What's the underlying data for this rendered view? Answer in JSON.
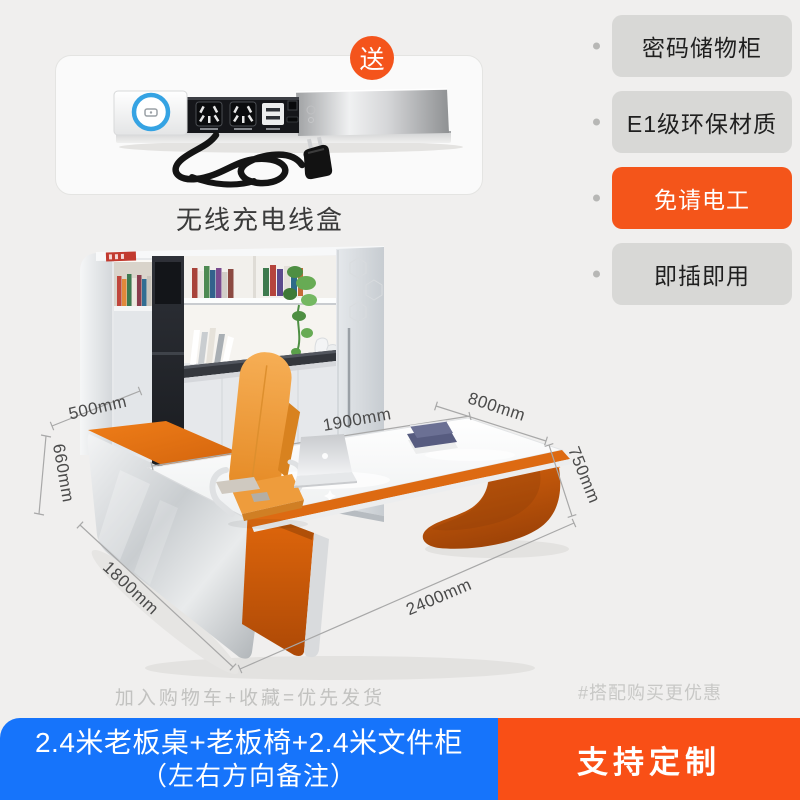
{
  "gift_section": {
    "badge_label": "送",
    "caption": "无线充电线盒"
  },
  "features": {
    "items": [
      {
        "label": "密码储物柜",
        "highlighted": false
      },
      {
        "label": "E1级环保材质",
        "highlighted": false
      },
      {
        "label": "免请电工",
        "highlighted": true
      },
      {
        "label": "即插即用",
        "highlighted": false
      }
    ]
  },
  "main_image": {
    "dimensions": {
      "return_width": "500mm",
      "desk_width": "1900mm",
      "desk_depth": "800mm",
      "return_height": "660mm",
      "desk_height": "750mm",
      "return_length": "1800mm",
      "desk_length": "2400mm"
    }
  },
  "footer": {
    "promo_left": "加入购物车+收藏=优先发货",
    "promo_right": "#搭配购买更优惠",
    "bundle_title": "2.4米老板桌+老板椅+2.4米文件柜",
    "bundle_note": "（左右方向备注）",
    "customize_label": "支持定制"
  },
  "colors": {
    "page_bg": "#F0EFEE",
    "accent_orange": "#F4551A",
    "banner_orange": "#F94F16",
    "banner_blue": "#1674FB",
    "badge_grey": "#D8D8D6",
    "furniture_orange": "#D9660F",
    "chair_orange": "#EF9D3F"
  }
}
